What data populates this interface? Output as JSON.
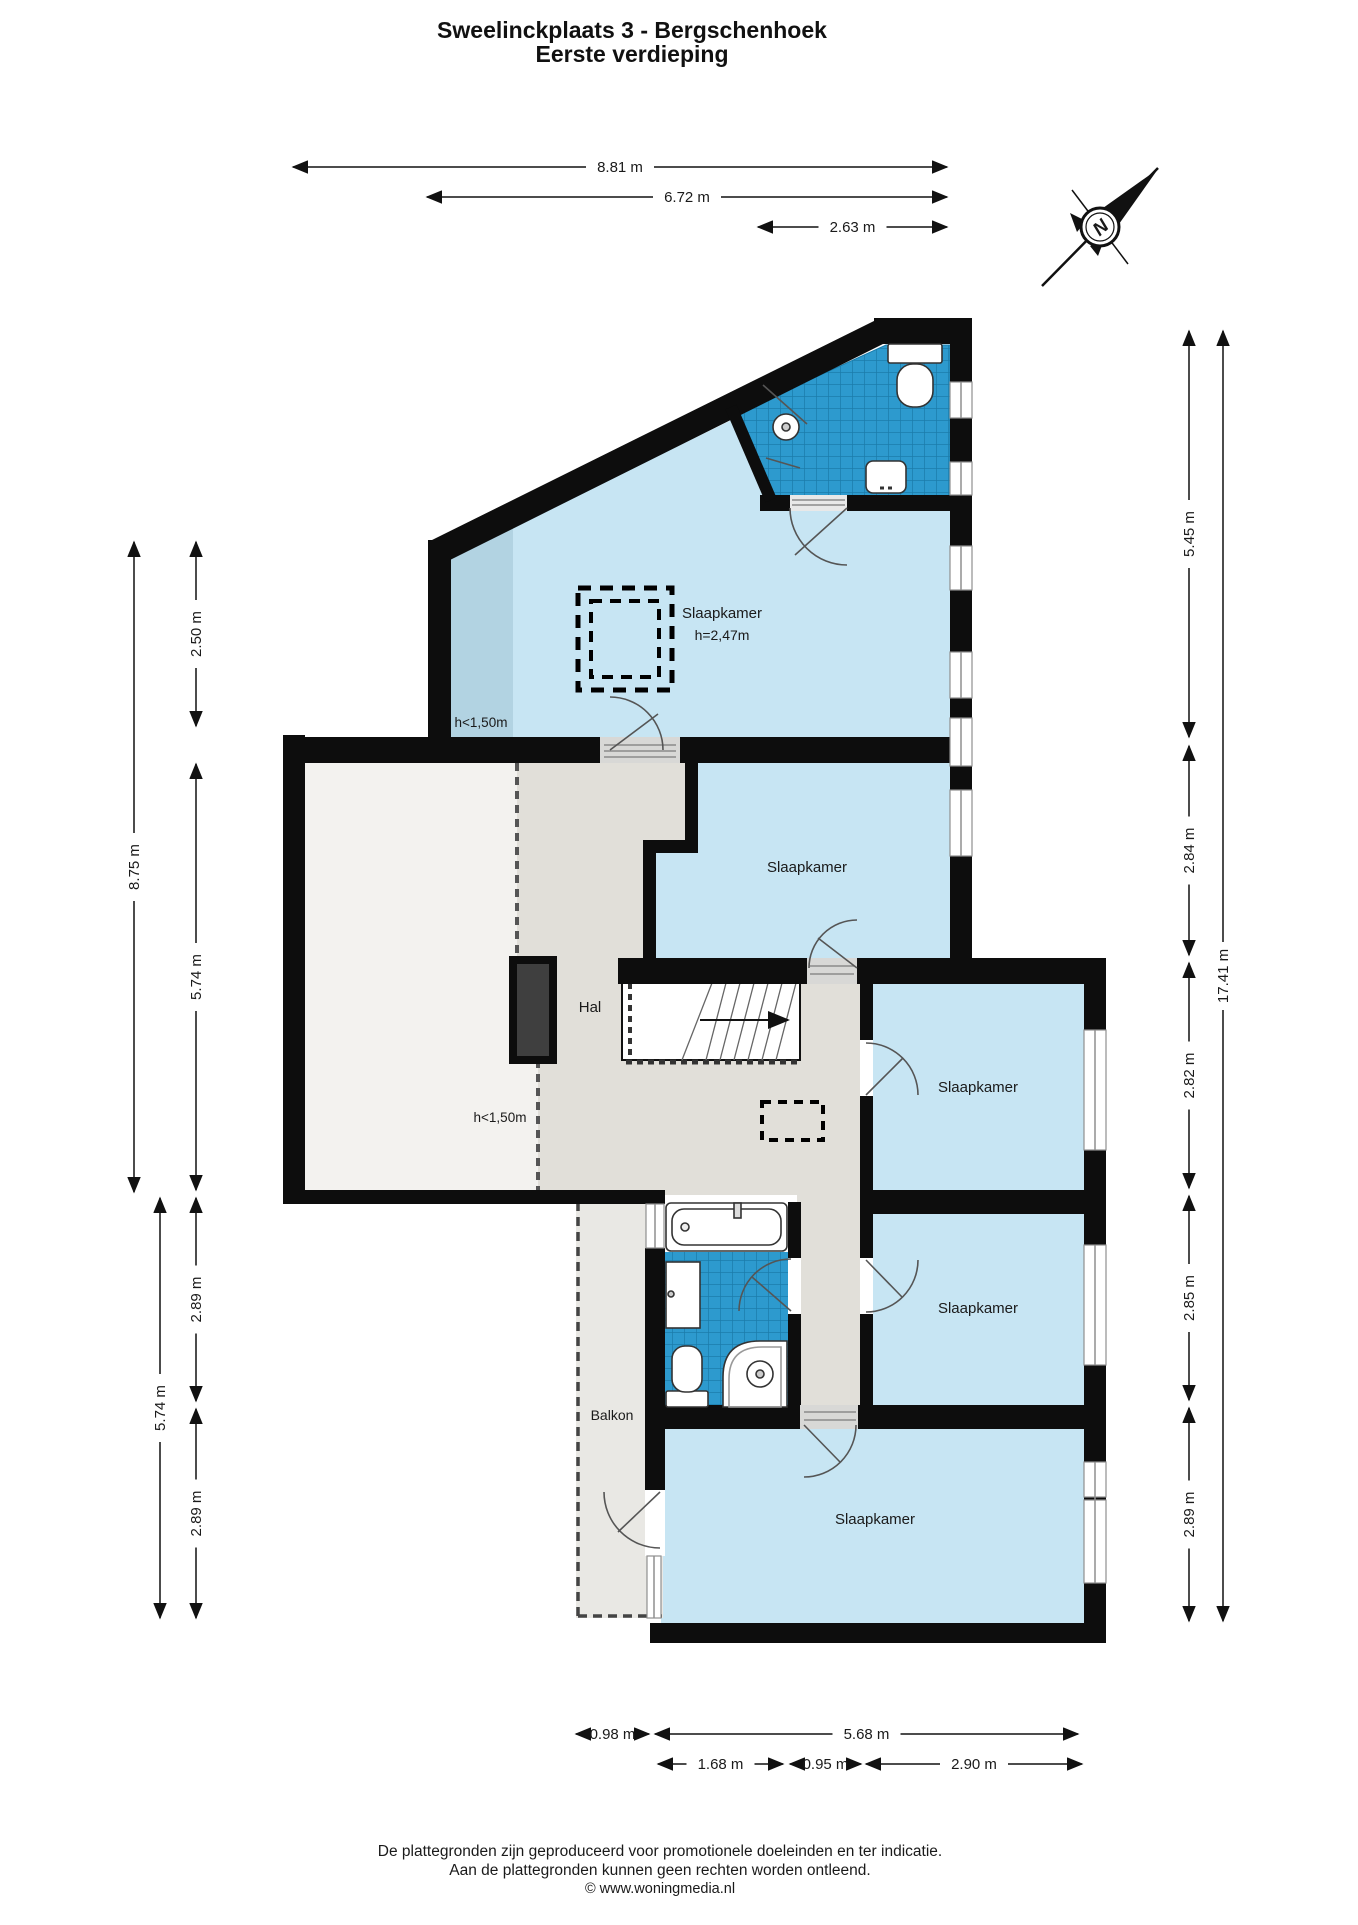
{
  "title": {
    "line1": "Sweelinckplaats 3 - Bergschenhoek",
    "line2": "Eerste verdieping"
  },
  "compass": {
    "label": "N"
  },
  "rooms": [
    {
      "name": "slaapkamer-1-label",
      "label": "Slaapkamer",
      "x": 722,
      "y": 618,
      "size": 15
    },
    {
      "name": "slaapkamer-1-height",
      "label": "h=2,47m",
      "x": 722,
      "y": 640,
      "size": 14
    },
    {
      "name": "slaapkamer-1-lowroof",
      "label": "h<1,50m",
      "x": 481,
      "y": 727,
      "size": 13.5
    },
    {
      "name": "attic-lowroof",
      "label": "h<1,50m",
      "x": 500,
      "y": 1122,
      "size": 13.5
    },
    {
      "name": "hal-label",
      "label": "Hal",
      "x": 590,
      "y": 1012,
      "size": 15
    },
    {
      "name": "slaapkamer-2-label",
      "label": "Slaapkamer",
      "x": 807,
      "y": 872,
      "size": 15
    },
    {
      "name": "slaapkamer-3-label",
      "label": "Slaapkamer",
      "x": 978,
      "y": 1092,
      "size": 15
    },
    {
      "name": "slaapkamer-4-label",
      "label": "Slaapkamer",
      "x": 978,
      "y": 1313,
      "size": 15
    },
    {
      "name": "slaapkamer-5-label",
      "label": "Slaapkamer",
      "x": 875,
      "y": 1524,
      "size": 15
    },
    {
      "name": "balkon-label",
      "label": "Balkon",
      "x": 612,
      "y": 1420,
      "size": 14
    }
  ],
  "dimensions": {
    "top": [
      {
        "label": "8.81 m",
        "x1": 293,
        "y1": 167,
        "x2": 947,
        "y2": 167
      },
      {
        "label": "6.72 m",
        "x1": 427,
        "y1": 197,
        "x2": 947,
        "y2": 197
      },
      {
        "label": "2.63 m",
        "x1": 758,
        "y1": 227,
        "x2": 947,
        "y2": 227
      }
    ],
    "left": [
      {
        "label": "2.50 m",
        "x1": 196,
        "y1": 542,
        "x2": 196,
        "y2": 726
      },
      {
        "label": "5.74 m",
        "x1": 196,
        "y1": 764,
        "x2": 196,
        "y2": 1190
      },
      {
        "label": "2.89 m",
        "x1": 196,
        "y1": 1198,
        "x2": 196,
        "y2": 1401
      },
      {
        "label": "2.89 m",
        "x1": 196,
        "y1": 1409,
        "x2": 196,
        "y2": 1618
      },
      {
        "label": "8.75 m",
        "x1": 134,
        "y1": 542,
        "x2": 134,
        "y2": 1192
      },
      {
        "label": "5.74 m",
        "x1": 160,
        "y1": 1198,
        "x2": 160,
        "y2": 1618
      }
    ],
    "right": [
      {
        "label": "5.45 m",
        "x1": 1189,
        "y1": 331,
        "x2": 1189,
        "y2": 737
      },
      {
        "label": "2.84 m",
        "x1": 1189,
        "y1": 746,
        "x2": 1189,
        "y2": 955
      },
      {
        "label": "2.82 m",
        "x1": 1189,
        "y1": 963,
        "x2": 1189,
        "y2": 1188
      },
      {
        "label": "2.85 m",
        "x1": 1189,
        "y1": 1196,
        "x2": 1189,
        "y2": 1400
      },
      {
        "label": "2.89 m",
        "x1": 1189,
        "y1": 1408,
        "x2": 1189,
        "y2": 1621
      },
      {
        "label": "17.41 m",
        "x1": 1223,
        "y1": 331,
        "x2": 1223,
        "y2": 1621
      }
    ],
    "bottom": [
      {
        "label": "0.98 m",
        "x1": 576,
        "y1": 1734,
        "x2": 649,
        "y2": 1734
      },
      {
        "label": "5.68 m",
        "x1": 655,
        "y1": 1734,
        "x2": 1078,
        "y2": 1734
      },
      {
        "label": "1.68 m",
        "x1": 658,
        "y1": 1764,
        "x2": 783,
        "y2": 1764
      },
      {
        "label": "0.95 m",
        "x1": 790,
        "y1": 1764,
        "x2": 861,
        "y2": 1764
      },
      {
        "label": "2.90 m",
        "x1": 866,
        "y1": 1764,
        "x2": 1082,
        "y2": 1764
      }
    ]
  },
  "footer": {
    "line1": "De plattegronden zijn geproduceerd voor promotionele doeleinden en ter indicatie.",
    "line2": "Aan de plattegronden kunnen geen rechten worden ontleend.",
    "line3": "© www.woningmedia.nl"
  },
  "colors": {
    "wall": "#0d0d0d",
    "room_blue": "#c7e5f3",
    "room_blue_low": "#b2d3e2",
    "tile_blue": "#2d9ace",
    "tile_grid": "#1b7cab",
    "hal_gray": "#e1dfd9",
    "attic_white": "#f3f2ef",
    "balkon_gray": "#e9e8e4"
  }
}
